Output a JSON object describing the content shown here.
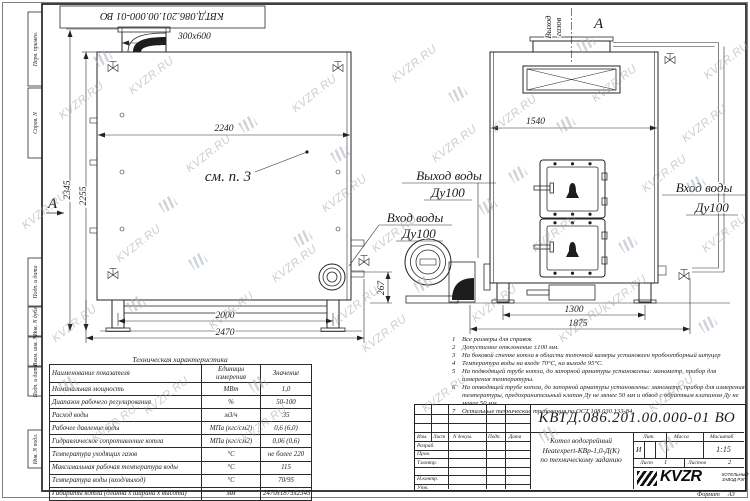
{
  "sheet": {
    "watermark": "KVZR.RU",
    "top_stamp": "КВТД.086.201.00.000-01 ВО",
    "format_label": "Формат",
    "format_value": "А3",
    "side_labels": [
      "Перв. примен.",
      "Справ. N",
      "Подп. и дата",
      "Инв. N дубл.",
      "Взам. инв. N",
      "Подп. и дата",
      "Инв. N подл."
    ]
  },
  "drawing": {
    "side_view": {
      "section": "А",
      "ref_note": "см. п. 3",
      "dim_chimney": "300x600",
      "dim_width": "2240",
      "dim_height_total": "2345",
      "dim_height_body": "2255",
      "dim_base": "2000",
      "dim_total": "2470",
      "dim_outlet": "267"
    },
    "front_view": {
      "section": "А",
      "gas1": "Выход",
      "gas2": "газов",
      "dim_width": "1540",
      "dim_base": "1300",
      "dim_total": "1875"
    },
    "pipe_labels": {
      "out1": "Выход воды",
      "out2": "Ду100",
      "in1": "Вход воды",
      "in2": "Ду100",
      "inr1": "Вход воды",
      "inr2": "Ду100"
    }
  },
  "notes": [
    {
      "n": "1",
      "text": "Все размеры для справок"
    },
    {
      "n": "2",
      "text": "Допустимое отклонение ±100 мм."
    },
    {
      "n": "3",
      "text": "На боковой стенке котла в области топочной камеры установлен пробоотборный штуцер"
    },
    {
      "n": "4",
      "text": "Температура воды на входе 70°С, на выходе 95°С."
    },
    {
      "n": "5",
      "text": "На подводящей трубе котла, до запорной арматуры установлены: манометр, прибор для измерения температуры."
    },
    {
      "n": "6",
      "text": "На отводящей трубе котла, до запорной арматуры установлены: манометр, прибор для измерения температуры, предохранительный клапан Ду не менее 50 мм и обвод с обратным клапаном Ду не менее 50 мм."
    },
    {
      "n": "7",
      "text": "Остальные технические требования по ОСТ 108.030.133-84."
    }
  ],
  "spec_table": {
    "title": "Техническая характеристика",
    "headers": [
      "Наименование показателя",
      "Единицы измерения",
      "Значение"
    ],
    "rows": [
      [
        "Номинальная мощность",
        "МВт",
        "1,0"
      ],
      [
        "Диапазон рабочего регулирования",
        "%",
        "50-100"
      ],
      [
        "Расход воды",
        "м3/ч",
        "35"
      ],
      [
        "Рабочее давление воды",
        "МПа (кгс/см2)",
        "0,6 (6,0)"
      ],
      [
        "Гидравлическое сопротивление котла",
        "МПа (кгс/см2)",
        "0,06 (0,6)"
      ],
      [
        "Температура уходящих газов",
        "°С",
        "не более 220"
      ],
      [
        "Максимальная рабочая температура воды",
        "°С",
        "115"
      ],
      [
        "Температура воды (вход/выход)",
        "°С",
        "70/95"
      ],
      [
        "Габариты котла (длинна х ширина х высота)",
        "мм",
        "2470х1875х2345"
      ]
    ]
  },
  "title_block": {
    "doc_number": "КВТД.086.201.00.000-01 ВО",
    "name_line1": "Котел водогрейный",
    "name_line2": "Heatexpert-КВр-1,0-Д(К)",
    "name_line3": "по техническому заданию",
    "col_izm": "Изм.",
    "col_list": "Лист",
    "col_ndoc": "N докум.",
    "col_podp": "Подп.",
    "col_data": "Дата",
    "row_razrab": "Разраб.",
    "row_prov": "Пров.",
    "row_tkontr": "Т.контр.",
    "row_nkontr": "Н.контр.",
    "row_utv": "Утв.",
    "lit_h": "Лит.",
    "lit_v": "И",
    "mass_h": "Масса",
    "scale_h": "Масштаб",
    "scale_v": "1:15",
    "list_h": "Лист",
    "list_v": "1",
    "listov_h": "Листов",
    "listov_v": "2",
    "logo_text": "KVZR",
    "company_line1": "КОТЕЛЬНЫЙ",
    "company_line2": "ЗАВОД РЭП"
  }
}
